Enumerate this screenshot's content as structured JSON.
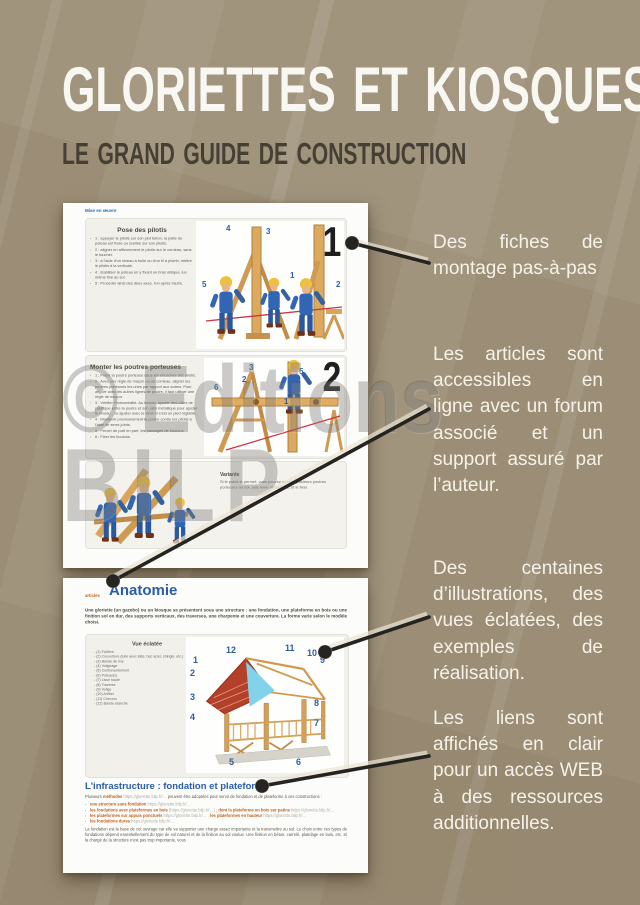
{
  "poster": {
    "title": "GLORIETTES ET KIOSQUES",
    "subtitle": "LE GRAND GUIDE DE CONSTRUCTION",
    "watermark_line1": "© Editions",
    "watermark_line2": "BILP",
    "colors": {
      "background": "#9c8e76",
      "accent_blue": "#2a5da8",
      "link_orange": "#c2601d",
      "callout_text": "#f6f2e9"
    }
  },
  "callouts": [
    {
      "text": "Des fiches de montage pas-à-pas"
    },
    {
      "text": "Les articles sont accessibles en ligne avec un forum associé et un support assuré par l’auteur."
    },
    {
      "text": "Des centaines d’illustrations, des vues éclatées, des exemples de réalisation."
    },
    {
      "text": "Les liens sont affichés en clair pour un accès WEB à des ressources additionnelles."
    }
  ],
  "sheet1": {
    "nav_link": "Mise en œuvre",
    "step1": {
      "number": "1",
      "heading": "Pose des pilotis",
      "bullets": [
        "1 : appuyer le pilotis sur son plot béton, la patte du poteau est fixée ou scellée sur son pilotis.",
        "2 : aligner en affleurement le pilotis sur le cordeau, sans le toucher.",
        "3 : à l'aide d'un niveau à bulle ou d'un fil à plomb, mettre le pilotis à la verticale.",
        "4 : stabiliser le poteau en y fixant un bras oblique, lui-même fixé au sol.",
        "5 : Procéder ainsi des deux axes, l'un après l'autre."
      ],
      "fig_numbers": [
        "1",
        "2",
        "3",
        "4",
        "5"
      ]
    },
    "step2": {
      "number": "2",
      "heading": "Monter les poutres porteuses",
      "bullets": [
        "1 : Poser la poutre porteuse dans les encoches des pilotis.",
        "2 : Avec une règle de maçon ou un cordeau, aligner les poutres porteuses les unes par rapport aux autres. Pour aligner avec les autres lignes de poutre, il faut utiliser une règle de maçon.",
        "3 : Vérifier l'horizontalité. Au besoin, ajouter des cales de plastique entre la poutre et son pied métallique pour ajuster le niveau ; ou ajuster avec le vérin si c'est un pied réglable.",
        "4 : Maintenir provisoirement la poutre contre les pilotis à l'aide de serre-joints.",
        "5 : Percer de part en part, les passages de boulons.",
        "6 : Fixer les boulons."
      ],
      "fig_numbers": [
        "1",
        "2",
        "3",
        "4",
        "5",
        "6"
      ]
    },
    "variante": {
      "heading": "Variante",
      "text": "Si le poids le permet, vous pouvez monter plusieurs poutres porteuses au sol, puis lever l'ensemble, et le fixer."
    }
  },
  "sheet2": {
    "kicker": "articles",
    "heading": "Anatomie",
    "intro": "Une gloriette (un gazebo) ou un kiosque se présentent sous une structure : une fondation, une plateforme en bois ou une finition sol en dur, des supports verticaux, des traverses, une charpente et une couverture. La forme varie selon le modèle choisi.",
    "exploded": {
      "title": "Vue éclatée",
      "items": [
        "(1) Faîtière",
        "(2) Couverture (tuile avec latte, bac acier, shingle, etc.)",
        "(3) Bande de rive",
        "(4) Voligeage",
        "(5) Contreventement",
        "(6) Poteau(x)",
        "(7) Lisse haute",
        "(8) Traverse",
        "(9) Volige",
        "(10) Arêtier",
        "(11) Chevron",
        "(12) Bande étanche"
      ],
      "fig_numbers": [
        "1",
        "2",
        "3",
        "4",
        "5",
        "6",
        "7",
        "8",
        "9",
        "10",
        "11",
        "12"
      ]
    },
    "infra": {
      "heading": "L'infrastructure : fondation et plateforme",
      "lead_pre": "Plusieurs",
      "lead_link": "méthodes",
      "lead_url": "https://gloriette.bilp.fr/…",
      "lead_post": "peuvent être adoptées pour servir de fondation et de plateforme à ces constructions :",
      "links": [
        {
          "label": "une structure sans fondation",
          "url": "https://gloriette.bilp.fr/…"
        },
        {
          "label": "les fondations avec plateformes en bois",
          "url": "(https://gloriette.bilp.fr/…)",
          "label2": "dont la plateforme en bois sur patins",
          "url2": "https://gloriette.bilp.fr/…"
        },
        {
          "label": "les plateformes sur appuis ponctuels",
          "url": "https://gloriette.bilp.fr/… ,",
          "label2": "les plateformes en hauteur",
          "url2": "https://gloriette.bilp.fr/…"
        },
        {
          "label": "les fondations dures",
          "url": "https://gloriette.bilp.fr/…"
        }
      ],
      "footer": "La fondation est la base de cet ouvrage car elle va supporter une charge assez importante et la transmettre au sol. Le choix entre ces types de fondations dépend essentiellement du type de sol naturel et de la finition au sol voulue. Une finition en béton, carrelé, platelage en bois, etc. Si la charge de la structure n'est pas trop importante, vous"
    }
  }
}
